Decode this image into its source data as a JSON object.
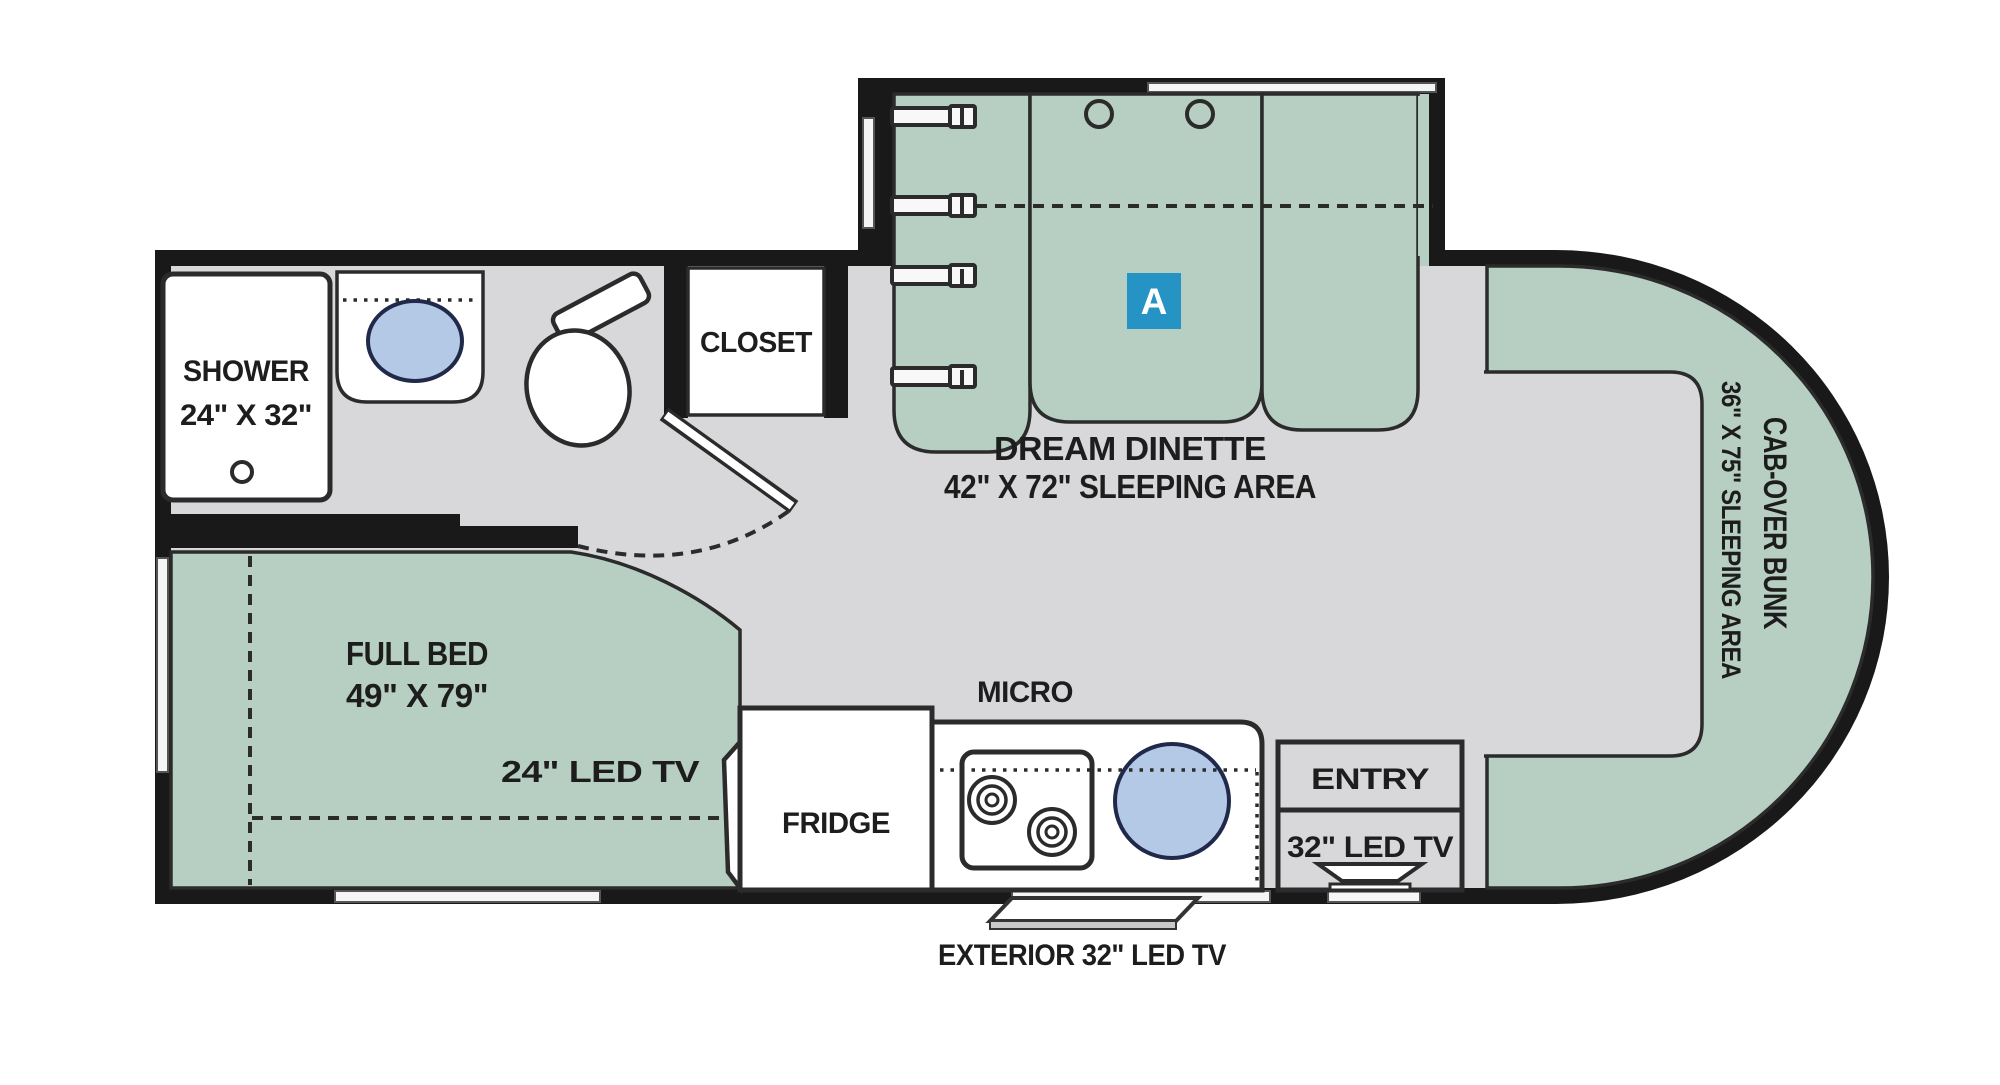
{
  "labels": {
    "shower": "SHOWER",
    "shower_size": "24\" X 32\"",
    "closet": "CLOSET",
    "dinette": "DREAM DINETTE",
    "dinette_size": "42\" X 72\" SLEEPING AREA",
    "dinette_badge": "A",
    "full_bed": "FULL BED",
    "full_bed_size": "49\" X 79\"",
    "bed_tv": "24\" LED TV",
    "fridge": "FRIDGE",
    "micro": "MICRO",
    "entry": "ENTRY",
    "entry_tv": "32\" LED TV",
    "exterior_tv": "EXTERIOR 32\" LED TV",
    "bunk": "CAB-OVER BUNK",
    "bunk_size": "36\" X 75\" SLEEPING AREA"
  },
  "colors": {
    "wall": "#191919",
    "floor": "#d8d8da",
    "green": "#b7cec3",
    "line": "#2b2b2b",
    "sink_fill": "#b3c9e6",
    "sink_stroke": "#20294a",
    "badge": "#2693c5",
    "text": "#1d1d1d",
    "window": "#f5f5f5"
  }
}
